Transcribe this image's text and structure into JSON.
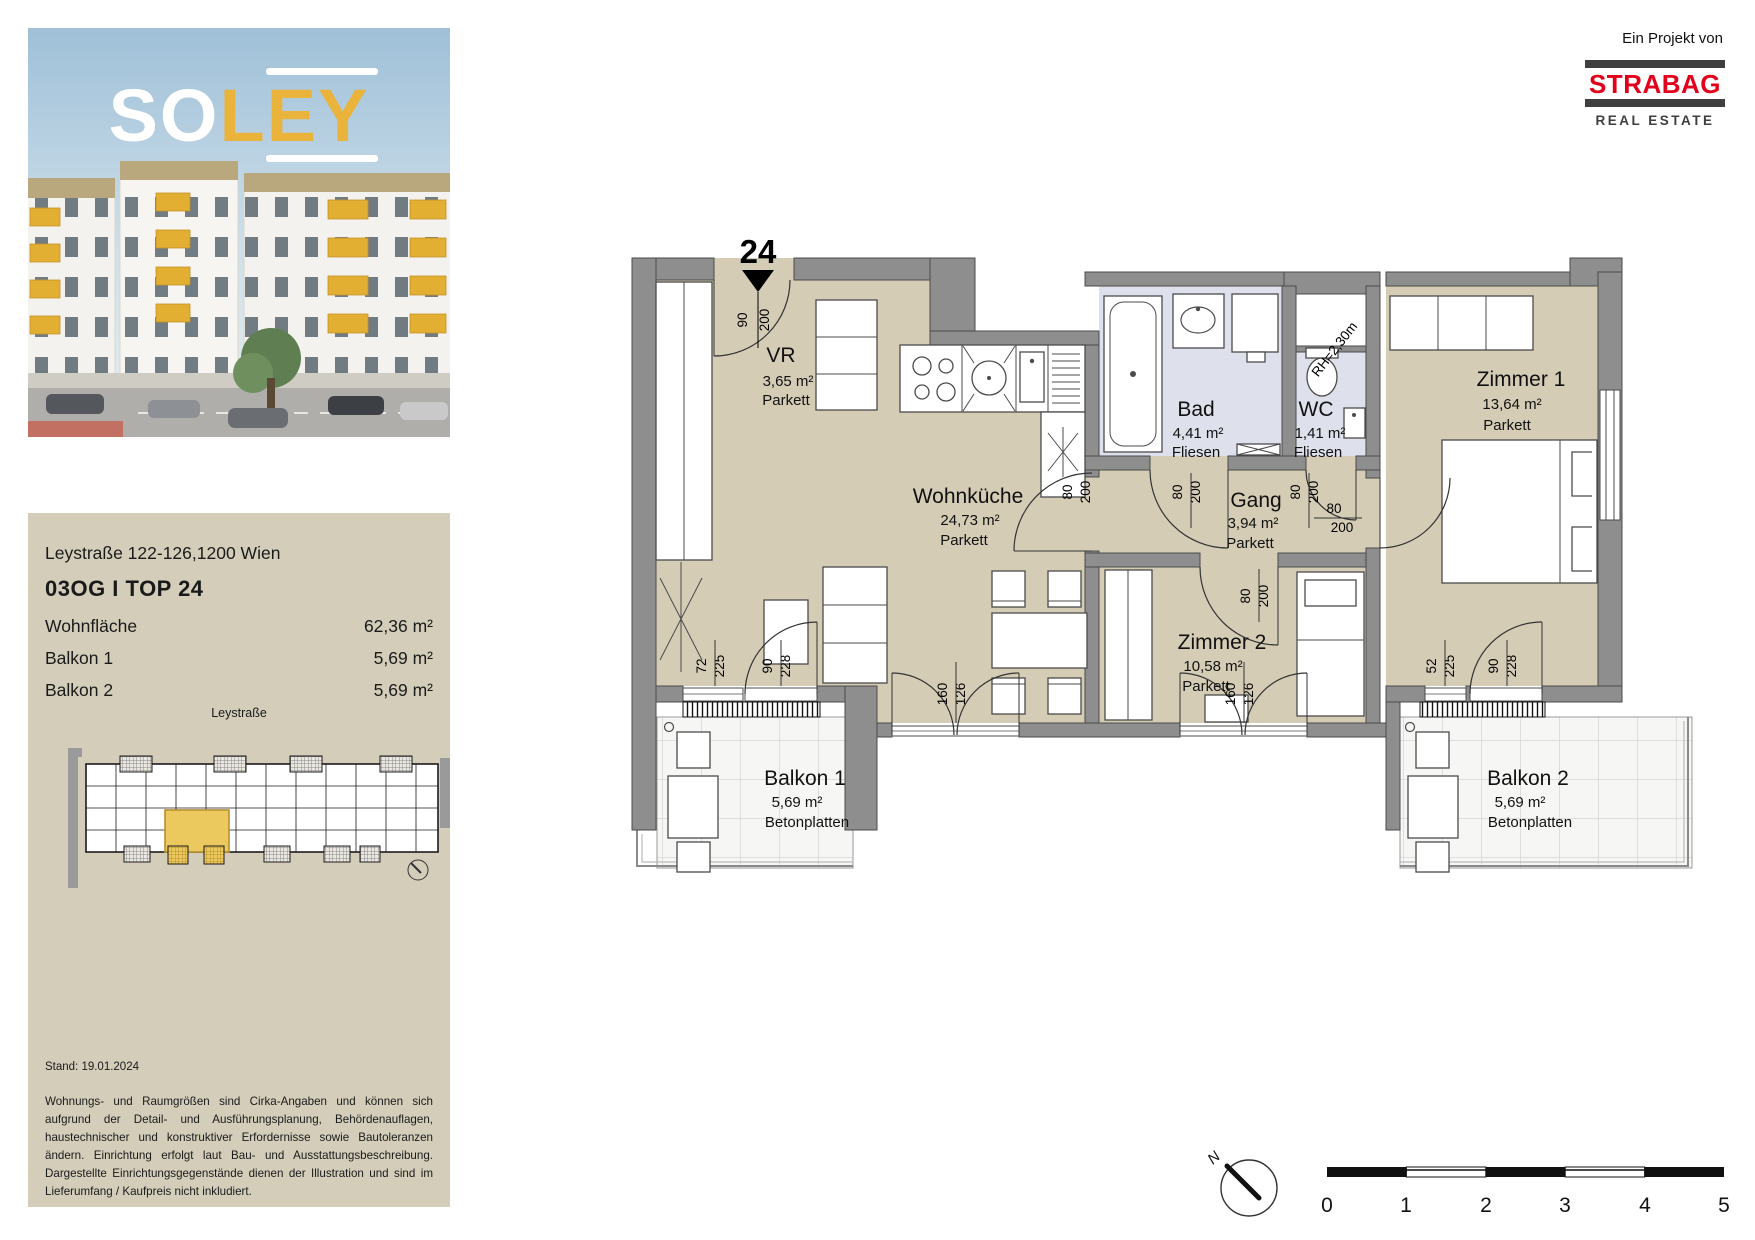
{
  "project": {
    "logo_so": "SO",
    "logo_ley": "LEY",
    "attribution": "Ein Projekt von",
    "brand": "STRABAG",
    "brand_sub": "REAL ESTATE"
  },
  "info_panel": {
    "address": "Leystraße 122-126,1200 Wien",
    "unit_title": "03OG I TOP 24",
    "rows": [
      {
        "label": "Wohnfläche",
        "value": "62,36 m²"
      },
      {
        "label": "Balkon 1",
        "value": "5,69 m²"
      },
      {
        "label": "Balkon 2",
        "value": "5,69 m²"
      }
    ],
    "street_label": "Leystraße",
    "stand": "Stand: 19.01.2024",
    "disclaimer": "Wohnungs- und Raumgrößen sind Cirka-Angaben und können sich aufgrund der Detail- und Ausführungsplanung, Behördenauflagen, haustechnischer und konstruktiver Erfordernisse sowie Bautoleranzen ändern. Einrichtung erfolgt laut Bau- und Ausstattungsbeschreibung. Dargestellte Einrichtungsgegenstände dienen der Illustration und sind im Lieferumfang / Kaufpreis nicht inkludiert."
  },
  "plan": {
    "marker": "24",
    "rh_note": "RH=2,30m",
    "north_label": "N",
    "scale_ticks": [
      "0",
      "1",
      "2",
      "3",
      "4",
      "5"
    ],
    "rooms": {
      "vr": {
        "name": "VR",
        "area": "3,65 m²",
        "finish": "Parkett"
      },
      "wohnkueche": {
        "name": "Wohnküche",
        "area": "24,73 m²",
        "finish": "Parkett"
      },
      "bad": {
        "name": "Bad",
        "area": "4,41 m²",
        "finish": "Fliesen"
      },
      "wc": {
        "name": "WC",
        "area": "1,41 m²",
        "finish": "Fliesen"
      },
      "gang": {
        "name": "Gang",
        "area": "3,94 m²",
        "finish": "Parkett"
      },
      "zimmer1": {
        "name": "Zimmer 1",
        "area": "13,64 m²",
        "finish": "Parkett"
      },
      "zimmer2": {
        "name": "Zimmer 2",
        "area": "10,58 m²",
        "finish": "Parkett"
      },
      "balkon1": {
        "name": "Balkon 1",
        "area": "5,69 m²",
        "finish": "Betonplatten"
      },
      "balkon2": {
        "name": "Balkon 2",
        "area": "5,69 m²",
        "finish": "Betonplatten"
      }
    },
    "dims": {
      "entry_w": "90",
      "entry_h": "200",
      "door_w": "80",
      "door_h": "200",
      "wk_window_w": "72",
      "wk_window_h": "225",
      "balcony_door_w": "90",
      "balcony_door_h": "228",
      "z1_window_w": "52",
      "z1_window_h": "225",
      "french_w": "160",
      "french_h": "126"
    },
    "colors": {
      "floor": "#d5ccb6",
      "wet_floor": "#dee1eb",
      "wall": "#8e8e8e",
      "highlight_unit": "#ecc95f",
      "brand_red": "#e2001a"
    }
  }
}
